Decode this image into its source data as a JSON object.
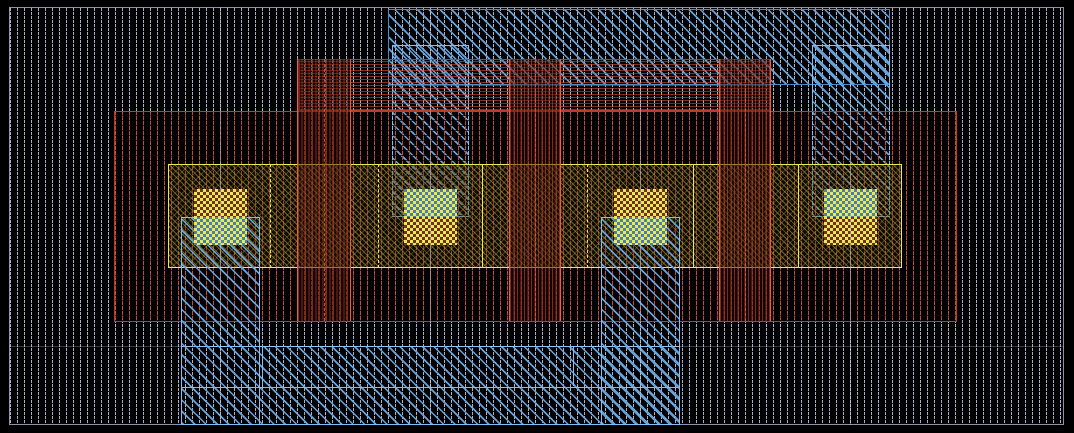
{
  "app": {
    "description": "IC mask layout viewport showing a four-contact multi-finger transistor with metal straps, poly gates and substrate hatching",
    "visible_text": "none"
  },
  "colors": {
    "frame": "#8f93a8",
    "sub": "#aeb0c6",
    "blue": "#67a4dc",
    "blueBorder": "#4a8cc8",
    "blueBright": "#7cc0f4",
    "red": "#c44b3a",
    "redBorder": "#c0392b",
    "gateLine": "#ef5b3d",
    "yel": "#e9e955",
    "ref": "rgba(200,208,230,0.45)"
  },
  "viewport": {
    "width": 1074,
    "height": 433
  },
  "shapes": [
    {
      "name": "substrate-region",
      "cls": "substrate",
      "x": 9,
      "y": 7,
      "w": 1055,
      "h": 418
    },
    {
      "name": "metal-top-plate",
      "cls": "mblue big",
      "x": 388,
      "y": 9,
      "w": 502,
      "h": 76
    },
    {
      "name": "metal-column-top-left",
      "cls": "mblue bright",
      "x": 392,
      "y": 45,
      "w": 77,
      "h": 172
    },
    {
      "name": "metal-column-top-right",
      "cls": "mblue bright",
      "x": 812,
      "y": 45,
      "w": 78,
      "h": 172
    },
    {
      "name": "poly-top-strap",
      "cls": "pdense",
      "x": 299,
      "y": 59,
      "w": 472,
      "h": 52
    },
    {
      "name": "well-implant-region",
      "cls": "pred",
      "x": 114,
      "y": 111,
      "w": 843,
      "h": 211
    },
    {
      "name": "active-area",
      "cls": "active",
      "x": 168,
      "y": 164,
      "w": 734,
      "h": 104
    },
    {
      "name": "metal-bottom-slab",
      "cls": "mblue bright",
      "x": 181,
      "y": 346,
      "w": 499,
      "h": 79
    },
    {
      "name": "metal-column-bottom-left",
      "cls": "mblue bright",
      "x": 181,
      "y": 217,
      "w": 79,
      "h": 208
    },
    {
      "name": "metal-column-bottom-mid",
      "cls": "mblue bright",
      "x": 601,
      "y": 217,
      "w": 79,
      "h": 208
    },
    {
      "name": "metal-seam-horizontal",
      "cls": "bline",
      "x": 181,
      "y": 387,
      "w": 499,
      "h": 1
    },
    {
      "name": "metal-seam-vertical-1",
      "cls": "bline",
      "x": 262,
      "y": 346,
      "w": 1,
      "h": 41
    },
    {
      "name": "metal-seam-vertical-2",
      "cls": "bline",
      "x": 573,
      "y": 346,
      "w": 1,
      "h": 40
    },
    {
      "name": "poly-gate-1",
      "cls": "gate",
      "x": 297,
      "y": 59,
      "w": 54,
      "h": 262
    },
    {
      "name": "poly-gate-2",
      "cls": "gate",
      "x": 509,
      "y": 59,
      "w": 52,
      "h": 262
    },
    {
      "name": "poly-gate-3",
      "cls": "gate",
      "x": 719,
      "y": 59,
      "w": 52,
      "h": 262
    },
    {
      "name": "contact-1",
      "cls": "contact",
      "x": 194,
      "y": 189,
      "w": 53,
      "h": 56,
      "halves": [
        "redbase",
        "bluebase"
      ]
    },
    {
      "name": "contact-2",
      "cls": "contact",
      "x": 404,
      "y": 189,
      "w": 53,
      "h": 56,
      "halves": [
        "bluebase",
        "redbase"
      ]
    },
    {
      "name": "contact-3",
      "cls": "contact",
      "x": 614,
      "y": 189,
      "w": 53,
      "h": 56,
      "halves": [
        "redbase",
        "bluebase"
      ]
    },
    {
      "name": "contact-4",
      "cls": "contact",
      "x": 824,
      "y": 189,
      "w": 53,
      "h": 56,
      "halves": [
        "bluebase",
        "redbase"
      ]
    },
    {
      "name": "active-boundary-dashed-1",
      "cls": "yline dashed",
      "x": 270,
      "y": 164,
      "w": 1,
      "h": 104
    },
    {
      "name": "active-boundary-dashed-2",
      "cls": "yline dashed",
      "x": 378,
      "y": 164,
      "w": 1,
      "h": 104
    },
    {
      "name": "active-boundary-dashed-3",
      "cls": "yline dashed",
      "x": 587,
      "y": 164,
      "w": 1,
      "h": 104
    },
    {
      "name": "active-boundary-solid-1",
      "cls": "yline",
      "x": 482,
      "y": 164,
      "w": 1,
      "h": 104
    },
    {
      "name": "active-boundary-solid-2",
      "cls": "yline",
      "x": 693,
      "y": 164,
      "w": 1,
      "h": 104
    },
    {
      "name": "active-boundary-solid-3",
      "cls": "yline",
      "x": 798,
      "y": 164,
      "w": 1,
      "h": 104
    },
    {
      "name": "cell-reference-line-1",
      "cls": "refline",
      "x": 220,
      "y": 7,
      "w": 1,
      "h": 418
    },
    {
      "name": "cell-reference-line-2",
      "cls": "refline",
      "x": 430,
      "y": 7,
      "w": 1,
      "h": 418
    },
    {
      "name": "cell-reference-line-3",
      "cls": "refline",
      "x": 640,
      "y": 7,
      "w": 1,
      "h": 418
    },
    {
      "name": "cell-reference-line-4",
      "cls": "refline",
      "x": 850,
      "y": 7,
      "w": 1,
      "h": 418
    },
    {
      "name": "well-reference-line",
      "cls": "refline h",
      "x": 9,
      "y": 346,
      "w": 1055,
      "h": 1
    }
  ]
}
